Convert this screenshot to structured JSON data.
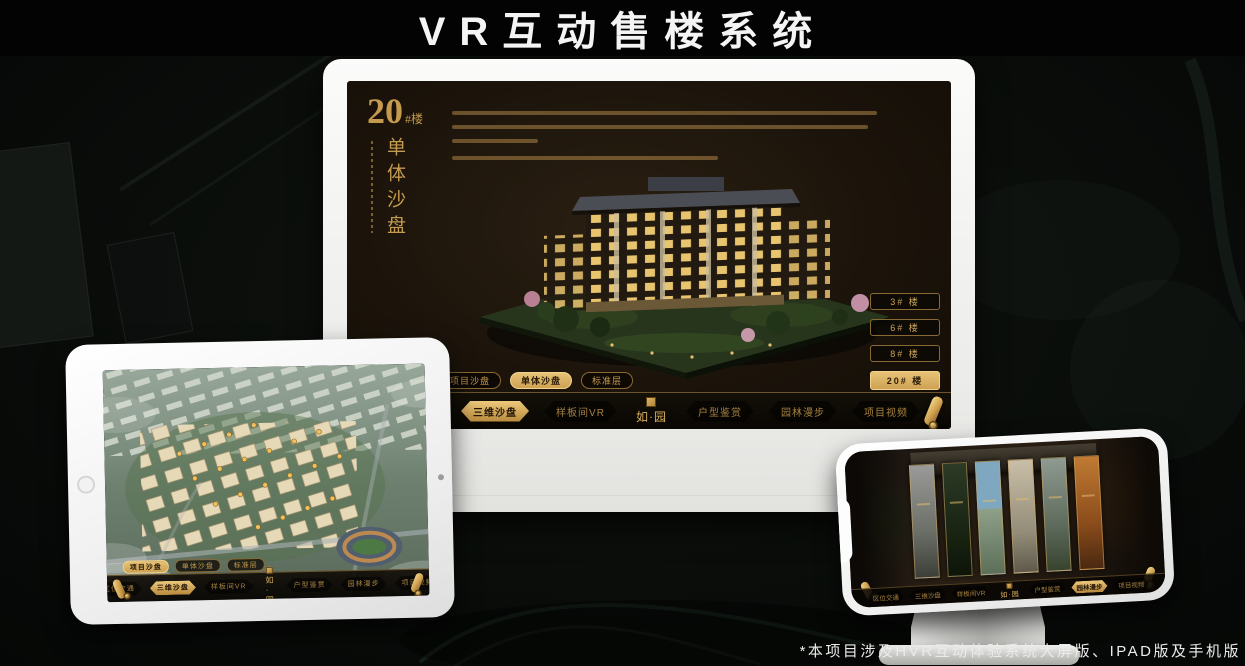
{
  "page": {
    "title": "VR互动售楼系统",
    "footnote": "*本项目涉及HVR互动体验系统大屏版、IPAD版及手机版"
  },
  "colors": {
    "gold_accent": "#d9b05e",
    "gold_dim": "#a5813f",
    "screen_background": "#1c140b",
    "frame_white": "#f4f4f2"
  },
  "branding": {
    "logo_text": "如·园",
    "logo_seal_icon": "gold-seal-stamp"
  },
  "desktop": {
    "unit_title": {
      "number": "20",
      "suffix": "#楼",
      "subtitle_vertical": "单体沙盘"
    },
    "floor_buttons": [
      {
        "label": "3# 楼",
        "active": false
      },
      {
        "label": "6# 楼",
        "active": false
      },
      {
        "label": "8# 楼",
        "active": false
      },
      {
        "label": "20# 楼",
        "active": true
      }
    ],
    "view_tabs": [
      {
        "label": "项目沙盘",
        "active": false
      },
      {
        "label": "单体沙盘",
        "active": true
      },
      {
        "label": "标准层",
        "active": false
      }
    ],
    "nav_items": [
      {
        "label": "区位交通",
        "active": false
      },
      {
        "label": "三维沙盘",
        "active": true
      },
      {
        "label": "样板间VR",
        "active": false
      },
      {
        "label": "户型鉴赏",
        "active": false
      },
      {
        "label": "园林漫步",
        "active": false
      },
      {
        "label": "项目视频",
        "active": false
      }
    ]
  },
  "tablet": {
    "view_tabs": [
      {
        "label": "项目沙盘",
        "active": true
      },
      {
        "label": "单体沙盘",
        "active": false
      },
      {
        "label": "标准层",
        "active": false
      }
    ],
    "nav_items": [
      {
        "label": "区位交通",
        "active": false
      },
      {
        "label": "三维沙盘",
        "active": true
      },
      {
        "label": "样板间VR",
        "active": false
      },
      {
        "label": "户型鉴赏",
        "active": false
      },
      {
        "label": "园林漫步",
        "active": false
      },
      {
        "label": "项目视频",
        "active": false
      }
    ]
  },
  "phone": {
    "nav_items": [
      {
        "label": "区位交通",
        "active": false
      },
      {
        "label": "三维沙盘",
        "active": false
      },
      {
        "label": "样板间VR",
        "active": false
      },
      {
        "label": "户型鉴赏",
        "active": false
      },
      {
        "label": "园林漫步",
        "active": true
      },
      {
        "label": "项目视频",
        "active": false
      }
    ]
  }
}
